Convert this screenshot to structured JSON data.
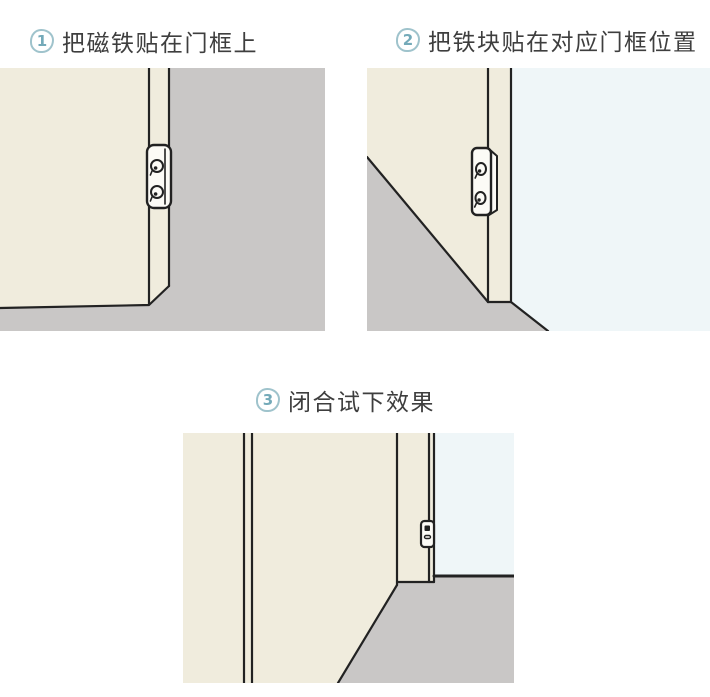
{
  "colors": {
    "page_bg": "#ffffff",
    "door_cream": "#f0ecdd",
    "floor_gray": "#c9c7c6",
    "wall_blue": "#eff6f8",
    "line": "#222222",
    "plate_white": "#fcfbf6",
    "title_text": "#3e3e3e",
    "badge_border": "#9fc3cc",
    "badge_number": "#74aab9"
  },
  "steps": [
    {
      "number": "1",
      "label": "把磁铁贴在门框上"
    },
    {
      "number": "2",
      "label": "把铁块贴在对应门框位置"
    },
    {
      "number": "3",
      "label": "闭合试下效果"
    }
  ]
}
